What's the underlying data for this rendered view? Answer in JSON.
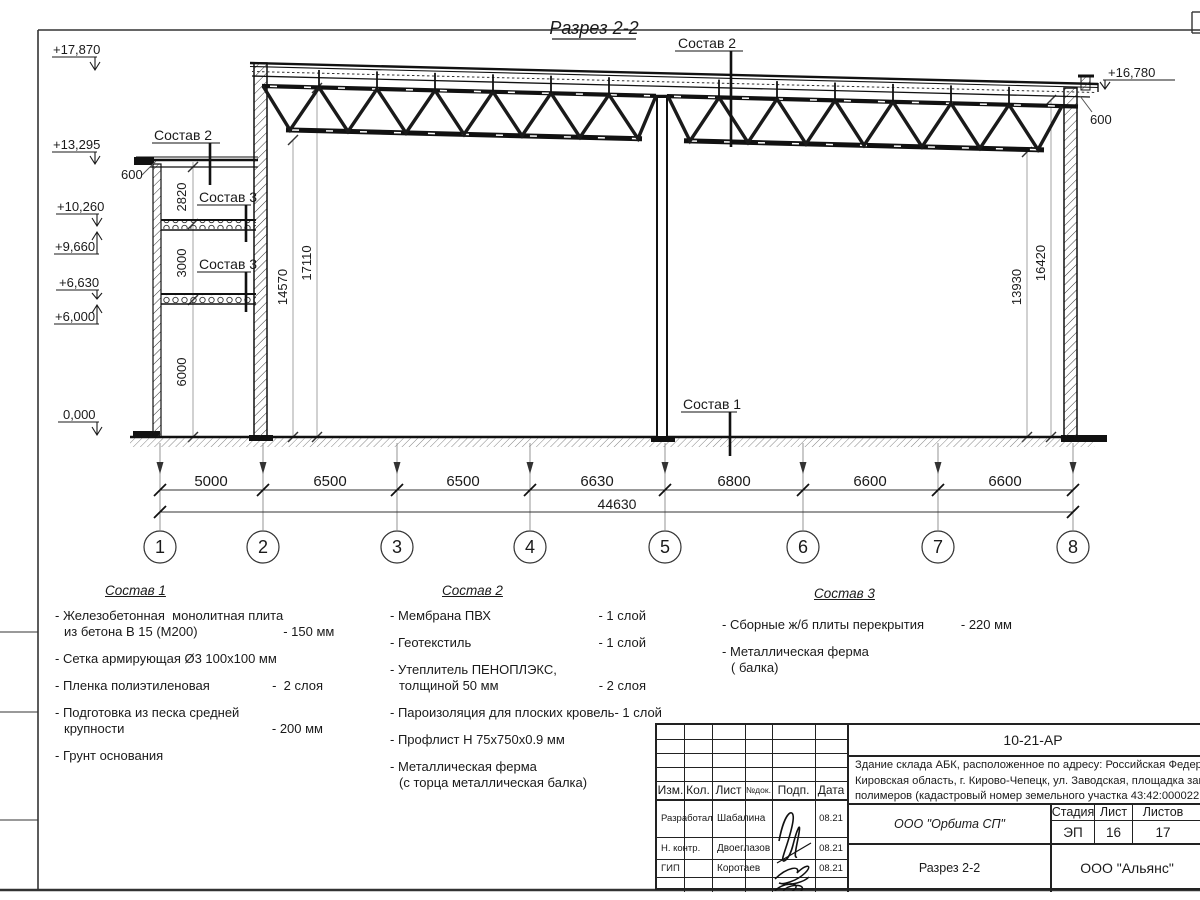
{
  "title": "Разрез 2-2",
  "marks_left": [
    {
      "v": "+17,870"
    },
    {
      "v": "+13,295"
    },
    {
      "v": "+10,260"
    },
    {
      "v": "+9,660"
    },
    {
      "v": "+6,630"
    },
    {
      "v": "+6,000"
    },
    {
      "v": "0,000"
    }
  ],
  "mark_right": "+16,780",
  "parapet_dims": {
    "left": "600",
    "right": "600"
  },
  "labels": {
    "sostav1": "Состав 1",
    "sostav2": "Состав 2",
    "sostav3": "Состав 3"
  },
  "vdims": {
    "annex": [
      "2820",
      "3000",
      "6000"
    ],
    "hall_left": [
      "14570",
      "17110"
    ],
    "hall_right": [
      "13930",
      "16420"
    ]
  },
  "spans": [
    "5000",
    "6500",
    "6500",
    "6630",
    "6800",
    "6600",
    "6600"
  ],
  "total": "44630",
  "axes": [
    "1",
    "2",
    "3",
    "4",
    "5",
    "6",
    "7",
    "8"
  ],
  "compositions": [
    {
      "title": "Состав 1",
      "items": [
        {
          "l1": "- Железобетонная  монолитная плита",
          "l2": "из бетона В 15 (М200)",
          "val": "- 150 мм"
        },
        {
          "l1": "- Сетка армирующая Ø3 100х100 мм"
        },
        {
          "l1": "- Пленка полиэтиленовая",
          "val": "-  2 слоя"
        },
        {
          "l1": "- Подготовка из песка средней",
          "l2": "крупности",
          "val": "- 200 мм"
        },
        {
          "l1": "- Грунт основания"
        }
      ]
    },
    {
      "title": "Состав 2",
      "items": [
        {
          "l1": "- Мембрана ПВХ",
          "val": "- 1 слой"
        },
        {
          "l1": "- Геотекстиль",
          "val": "- 1 слой"
        },
        {
          "l1": "- Утеплитель ПЕНОПЛЭКС,",
          "l2": "толщиной 50 мм",
          "val": "- 2 слоя"
        },
        {
          "l1": "- Пароизоляция для плоских кровель",
          "val": "- 1 слой"
        },
        {
          "l1": "- Профлист Н 75х750х0.9 мм"
        },
        {
          "l1": "- Металлическая ферма",
          "l2": "(с торца металлическая балка)"
        }
      ]
    },
    {
      "title": "Состав 3",
      "items": [
        {
          "l1": "- Сборные ж/б плиты перекрытия",
          "val": "- 220 мм"
        },
        {
          "l1": "- Металлическая ферма",
          "l2": "( балка)"
        }
      ]
    }
  ],
  "titleblock": {
    "doc_number": "10-21-АР",
    "description_lines": [
      "Здание склада АБК, расположенное по адресу: Российская Федерация,",
      "Кировская область, г. Кирово-Чепецк, ул. Заводская, площадка завода",
      "полимеров (кадастровый номер земельного участка 43:42:000022:3"
    ],
    "columns_header": [
      "Изм.",
      "Кол.",
      "Лист",
      "№док.",
      "Подп.",
      "Дата"
    ],
    "rows": [
      {
        "role": "Разработал",
        "name": "Шабалина",
        "date": "08.21"
      },
      {
        "role": "Н. контр.",
        "name": "Двоеглазов",
        "date": "08.21"
      },
      {
        "role": "ГИП",
        "name": "Коротаев",
        "date": "08.21"
      }
    ],
    "org_middle": "ООО \"Орбита СП\"",
    "stage_header": [
      "Стадия",
      "Лист",
      "Листов"
    ],
    "stage_values": [
      "ЭП",
      "16",
      "17"
    ],
    "sheet_name": "Разрез 2-2",
    "org_bottom": "ООО \"Альянс\""
  }
}
